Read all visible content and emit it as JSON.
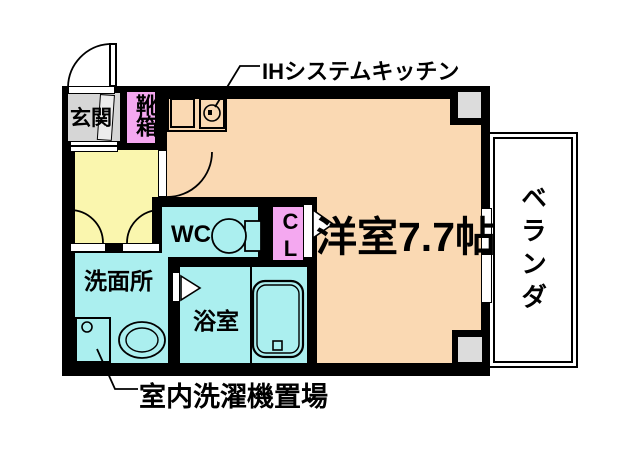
{
  "floorplan": {
    "title": "1K apartment floor plan",
    "labels": {
      "entrance": "玄関",
      "shoe_cabinet": "靴箱",
      "kitchen_callout": "IHシステムキッチン",
      "main_room": "洋室7.7帖",
      "toilet": "WC",
      "closet": "CL",
      "washroom": "洗面所",
      "bathroom": "浴室",
      "veranda": "ベランダ",
      "laundry_callout": "室内洗濯機置場"
    },
    "colors": {
      "wall": "#000000",
      "main_room": "#FAD9B3",
      "hall": "#FAF6AE",
      "wet_area": "#ABEFEF",
      "closet_pink": "#F4A8F0",
      "entrance_gray": "#D6D6D6",
      "pillar_gray": "#DCDCDC",
      "veranda_bg": "#FFFFFF"
    }
  }
}
